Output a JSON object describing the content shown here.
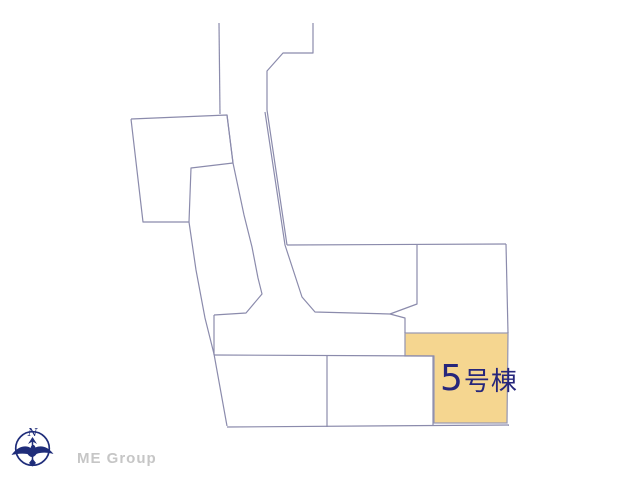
{
  "canvas": {
    "width": 640,
    "height": 480,
    "background": "#ffffff"
  },
  "site_plan": {
    "line_color": "#8b8bac",
    "boundaries": [
      {
        "name": "road-left-upper-edge",
        "points": [
          [
            219,
            23
          ],
          [
            220,
            114
          ]
        ]
      },
      {
        "name": "road-right-upper-edge",
        "points": [
          [
            313,
            23
          ],
          [
            313,
            53
          ],
          [
            283,
            53
          ],
          [
            267,
            71
          ],
          [
            267,
            110
          ],
          [
            287,
            245
          ]
        ]
      },
      {
        "name": "road-right-lower-edge",
        "points": [
          [
            265,
            112
          ],
          [
            285,
            245
          ],
          [
            302,
            297
          ],
          [
            315,
            312
          ],
          [
            390,
            314
          ]
        ]
      },
      {
        "name": "north-block-top-boundary",
        "points": [
          [
            287,
            245
          ],
          [
            506,
            244
          ]
        ]
      },
      {
        "name": "east-boundary",
        "points": [
          [
            506,
            244
          ],
          [
            508,
            333
          ]
        ]
      },
      {
        "name": "north-block-divider",
        "points": [
          [
            417,
            244
          ],
          [
            417,
            304
          ],
          [
            390,
            314
          ]
        ]
      },
      {
        "name": "road-corner-wedge",
        "points": [
          [
            390,
            314
          ],
          [
            405,
            318
          ],
          [
            405,
            333
          ]
        ]
      },
      {
        "name": "northwest-parcel-outline",
        "points": [
          [
            131,
            119
          ],
          [
            227,
            115
          ],
          [
            233,
            163
          ],
          [
            191,
            168
          ],
          [
            189,
            222
          ],
          [
            143,
            222
          ],
          [
            131,
            119
          ]
        ]
      },
      {
        "name": "road-left-lower-edge",
        "points": [
          [
            227,
            115
          ],
          [
            233,
            163
          ],
          [
            244,
            215
          ],
          [
            252,
            247
          ],
          [
            258,
            278
          ],
          [
            262,
            294
          ],
          [
            246,
            313
          ],
          [
            214,
            315
          ]
        ]
      },
      {
        "name": "west-outer-boundary",
        "points": [
          [
            189,
            222
          ],
          [
            196,
            270
          ],
          [
            205,
            318
          ],
          [
            214,
            354
          ],
          [
            227,
            426
          ]
        ]
      },
      {
        "name": "road-west-end-cap",
        "points": [
          [
            214,
            315
          ],
          [
            214,
            355
          ]
        ]
      },
      {
        "name": "south-block-top-boundary",
        "points": [
          [
            214,
            355
          ],
          [
            434,
            356
          ]
        ]
      },
      {
        "name": "south-block-bottom-boundary",
        "points": [
          [
            227,
            427
          ],
          [
            509,
            425
          ]
        ]
      },
      {
        "name": "south-block-divider",
        "points": [
          [
            327,
            356
          ],
          [
            327,
            427
          ]
        ]
      },
      {
        "name": "south-block-right-divider",
        "points": [
          [
            433,
            356
          ],
          [
            433,
            425
          ]
        ]
      }
    ],
    "highlight_parcel": {
      "label": "5号棟",
      "label_number": "5",
      "label_suffix": "号棟",
      "fill": "#f5d690",
      "stroke": "#9a9ab2",
      "label_color": "#26267b",
      "points": [
        [
          405,
          333
        ],
        [
          508,
          333
        ],
        [
          507,
          423
        ],
        [
          434,
          423
        ],
        [
          434,
          356
        ],
        [
          405,
          356
        ],
        [
          405,
          333
        ]
      ]
    }
  },
  "branding": {
    "company": "ME Group",
    "logo_color": "#c6c6c6",
    "compass": {
      "letter": "N",
      "color": "#1f2d7a"
    }
  }
}
